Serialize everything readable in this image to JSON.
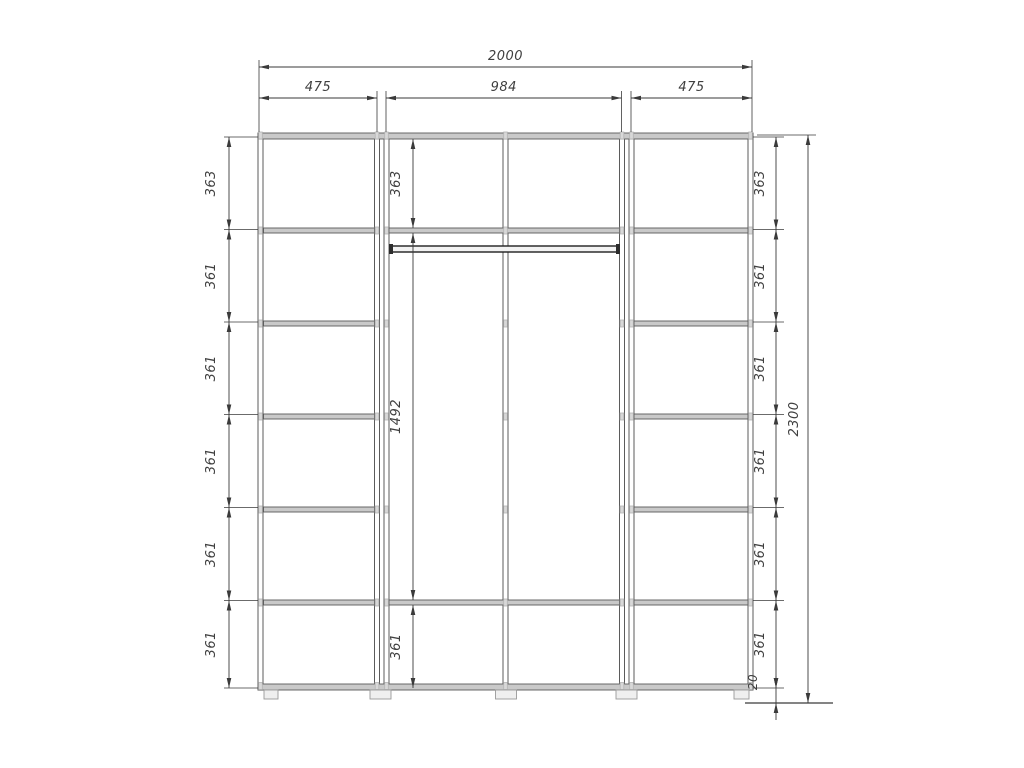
{
  "drawing": {
    "type": "wardrobe-elevation-dimension-drawing",
    "background": "#ffffff",
    "line_color": "#3a3a3a",
    "panel_fill": "#c9c9c9",
    "panel_edge": "#5a5a5a",
    "fitting_color": "#b5b5b5",
    "dims": {
      "overall_width": "2000",
      "top_sections": [
        "475",
        "984",
        "475"
      ],
      "left_column": [
        "363",
        "361",
        "361",
        "361",
        "361",
        "361"
      ],
      "middle_column": [
        "363",
        "1492",
        "361"
      ],
      "right_column": [
        "363",
        "361",
        "361",
        "361",
        "361",
        "361"
      ],
      "overall_height": "2300",
      "base_height": "20"
    }
  }
}
